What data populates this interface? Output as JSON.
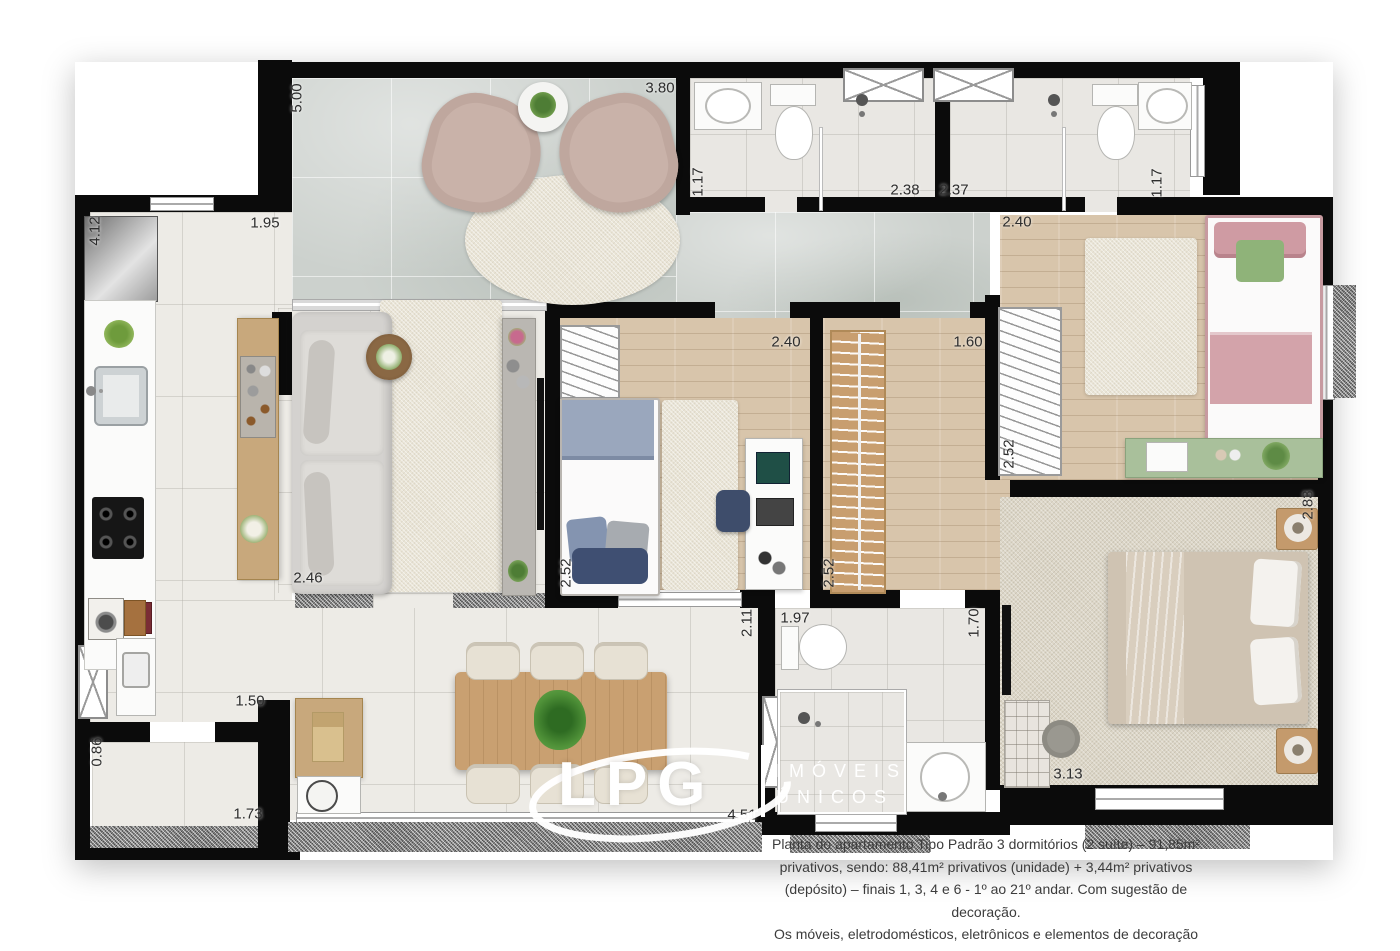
{
  "caption": {
    "para1": "Planta do apartamento Tipo Padrão 3 dormitórios (2 suíte) – 91,85m² privativos, sendo: 88,41m² privativos (unidade) + 3,44m² privativos (depósito) – finais 1, 3, 4 e 6 - 1º ao 21º andar. Com sugestão de decoração.",
    "para2": "Os móveis, eletrodomésticos, eletrônicos e elementos de decoração não fazem parte do contrato de compra e venda da unidade. Medidas de face a face."
  },
  "logo": {
    "brand": "LPG",
    "tagline_line1": "IMÓVEIS",
    "tagline_line2": "ÚNICOS"
  },
  "dimensions": [
    {
      "value": "5.00",
      "x": 297,
      "y": 98,
      "rot": true
    },
    {
      "value": "3.80",
      "x": 660,
      "y": 88,
      "rot": false
    },
    {
      "value": "1.17",
      "x": 698,
      "y": 182,
      "rot": true
    },
    {
      "value": "2.38",
      "x": 905,
      "y": 190,
      "rot": false
    },
    {
      "value": "2.37",
      "x": 954,
      "y": 190,
      "rot": false
    },
    {
      "value": "1.17",
      "x": 1157,
      "y": 183,
      "rot": true
    },
    {
      "value": "2.40",
      "x": 1017,
      "y": 222,
      "rot": false
    },
    {
      "value": "2.52",
      "x": 1009,
      "y": 454,
      "rot": true
    },
    {
      "value": "4.12",
      "x": 95,
      "y": 231,
      "rot": true
    },
    {
      "value": "1.95",
      "x": 265,
      "y": 223,
      "rot": false
    },
    {
      "value": "2.46",
      "x": 308,
      "y": 578,
      "rot": false
    },
    {
      "value": "2.40",
      "x": 786,
      "y": 342,
      "rot": false
    },
    {
      "value": "2.52",
      "x": 566,
      "y": 573,
      "rot": true
    },
    {
      "value": "1.60",
      "x": 968,
      "y": 342,
      "rot": false
    },
    {
      "value": "2.52",
      "x": 829,
      "y": 573,
      "rot": true
    },
    {
      "value": "2.83",
      "x": 1308,
      "y": 505,
      "rot": true
    },
    {
      "value": "3.13",
      "x": 1068,
      "y": 774,
      "rot": false
    },
    {
      "value": "1.97",
      "x": 795,
      "y": 618,
      "rot": false
    },
    {
      "value": "1.70",
      "x": 974,
      "y": 623,
      "rot": true
    },
    {
      "value": "2.11",
      "x": 747,
      "y": 623,
      "rot": true
    },
    {
      "value": "1.50",
      "x": 250,
      "y": 701,
      "rot": false
    },
    {
      "value": "0.86",
      "x": 97,
      "y": 752,
      "rot": true
    },
    {
      "value": "1.73",
      "x": 248,
      "y": 814,
      "rot": false
    },
    {
      "value": "4.51",
      "x": 742,
      "y": 815,
      "rot": false
    }
  ],
  "colors": {
    "wall": "#0b0b0b",
    "floor_tile": "#edebe6",
    "marble": "#ccd1cd",
    "wood": "#d8c5ab",
    "carpet": "#dcd6c7",
    "accent_pink": "#d9aab0",
    "accent_blue": "#93a2bc",
    "accent_green": "#a9c09b",
    "table_wood": "#c9a071"
  }
}
